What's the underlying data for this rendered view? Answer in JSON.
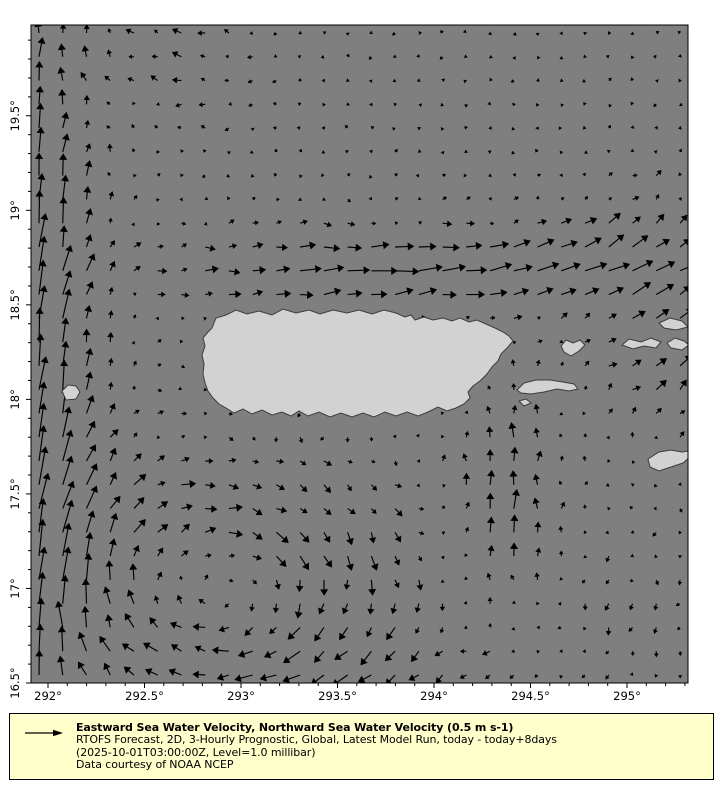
{
  "legend": {
    "title": "Eastward Sea Water Velocity, Northward Sea Water Velocity (0.5 m s-1)",
    "line2": "RTOFS Forecast, 2D, 3-Hourly Prognostic, Global, Latest Model Run, today - today+8days",
    "line3": "(2025-10-01T03:00:00Z, Level=1.0 millibar)",
    "line4": "Data courtesy of NOAA NCEP",
    "background": "#ffffcc",
    "border_color": "#000000",
    "key_arrow_icon": "reference-velocity-arrow"
  },
  "chart_data": {
    "type": "quiver",
    "title": "Eastward Sea Water Velocity, Northward Sea Water Velocity",
    "reference_vector": {
      "value": 0.5,
      "units": "m s-1"
    },
    "x_axis": {
      "tick_values": [
        292,
        292.5,
        293,
        293.5,
        294,
        294.5,
        295
      ],
      "tick_labels": [
        "292°",
        "292.5°",
        "293°",
        "293.5°",
        "294°",
        "294.5°",
        "295°"
      ],
      "range": [
        291.912,
        295.316
      ],
      "minor_step": 0.1
    },
    "y_axis": {
      "tick_values": [
        19.5,
        19,
        18.5,
        18,
        17.5,
        17,
        16.5
      ],
      "tick_labels": [
        "19.5°",
        "19°",
        "18.5°",
        "18°",
        "17.5°",
        "17°",
        "16.5°"
      ],
      "range": [
        16.5,
        19.98
      ],
      "minor_step": 0.1
    },
    "colors": {
      "ocean": "#7f7f7f",
      "land": "#d2d2d2",
      "coast": "#3c3c3c",
      "arrow": "#000000",
      "axis": "#000000"
    },
    "grid": {
      "cols": 28,
      "rows": 28,
      "inset_px": 8,
      "scale_px_per_unit": 75,
      "max_arrow_px": 40,
      "noise_amplitude": 0.045
    },
    "flow_features": [
      {
        "name": "mona-passage-northward-jet",
        "type": "gauss",
        "lon0": 291.88,
        "lat0": 18.2,
        "sx": 0.36,
        "sy": 1.9,
        "u": 0.05,
        "v": 0.48
      },
      {
        "name": "northwest-westward-turn",
        "type": "gauss",
        "lon0": 292.6,
        "lat0": 19.8,
        "sx": 0.5,
        "sy": 0.35,
        "u": -0.1,
        "v": 0.02
      },
      {
        "name": "north-coast-eastward-band",
        "type": "gauss",
        "lon0": 293.9,
        "lat0": 18.68,
        "sx": 1.25,
        "sy": 0.22,
        "u": 0.32,
        "v": 0.03
      },
      {
        "name": "northeast-tilt",
        "type": "gauss",
        "lon0": 295.1,
        "lat0": 18.8,
        "sx": 0.6,
        "sy": 0.35,
        "u": 0.1,
        "v": 0.12
      },
      {
        "name": "southwest-anticyclonic-eddy",
        "type": "eddy",
        "lon0": 292.9,
        "lat0": 17.0,
        "rx": 0.85,
        "ry": 0.62,
        "k": 0.42
      },
      {
        "name": "southeast-northward-band",
        "type": "gauss",
        "lon0": 294.35,
        "lat0": 17.45,
        "sx": 0.3,
        "sy": 0.6,
        "u": 0.0,
        "v": 0.26
      },
      {
        "name": "east-northeast-flow",
        "type": "gauss",
        "lon0": 295.3,
        "lat0": 18.2,
        "sx": 0.5,
        "sy": 0.4,
        "u": 0.13,
        "v": 0.12
      },
      {
        "name": "south-coast-westward-drift",
        "type": "gauss",
        "lon0": 293.5,
        "lat0": 17.85,
        "sx": 0.7,
        "sy": 0.16,
        "u": -0.09,
        "v": -0.02
      },
      {
        "name": "southeast-corner-southward-drift",
        "type": "gauss",
        "lon0": 295.1,
        "lat0": 16.9,
        "sx": 0.5,
        "sy": 0.4,
        "u": -0.02,
        "v": -0.08
      },
      {
        "name": "south-bottom-westward",
        "type": "gauss",
        "lon0": 293.8,
        "lat0": 16.6,
        "sx": 0.8,
        "sy": 0.25,
        "u": -0.08,
        "v": -0.03
      }
    ],
    "islands": [
      {
        "name": "puerto-rico",
        "points": [
          [
            212,
            328
          ],
          [
            216,
            318
          ],
          [
            226,
            315
          ],
          [
            236,
            310
          ],
          [
            247,
            314
          ],
          [
            259,
            311
          ],
          [
            272,
            315
          ],
          [
            283,
            309
          ],
          [
            296,
            313
          ],
          [
            309,
            310
          ],
          [
            320,
            314
          ],
          [
            333,
            310
          ],
          [
            347,
            313
          ],
          [
            359,
            310
          ],
          [
            372,
            314
          ],
          [
            384,
            310
          ],
          [
            396,
            313
          ],
          [
            405,
            317
          ],
          [
            411,
            315
          ],
          [
            415,
            320
          ],
          [
            424,
            317
          ],
          [
            433,
            320
          ],
          [
            443,
            318
          ],
          [
            452,
            321
          ],
          [
            460,
            318
          ],
          [
            469,
            322
          ],
          [
            477,
            320
          ],
          [
            486,
            324
          ],
          [
            495,
            328
          ],
          [
            503,
            332
          ],
          [
            509,
            336
          ],
          [
            513,
            341
          ],
          [
            507,
            348
          ],
          [
            501,
            354
          ],
          [
            498,
            361
          ],
          [
            492,
            367
          ],
          [
            487,
            374
          ],
          [
            480,
            381
          ],
          [
            473,
            386
          ],
          [
            468,
            392
          ],
          [
            470,
            398
          ],
          [
            464,
            404
          ],
          [
            456,
            408
          ],
          [
            447,
            411
          ],
          [
            438,
            407
          ],
          [
            428,
            412
          ],
          [
            418,
            416
          ],
          [
            407,
            412
          ],
          [
            396,
            416
          ],
          [
            385,
            412
          ],
          [
            374,
            417
          ],
          [
            363,
            413
          ],
          [
            352,
            417
          ],
          [
            341,
            413
          ],
          [
            330,
            417
          ],
          [
            319,
            412
          ],
          [
            308,
            416
          ],
          [
            299,
            411
          ],
          [
            291,
            416
          ],
          [
            282,
            412
          ],
          [
            272,
            415
          ],
          [
            262,
            410
          ],
          [
            252,
            414
          ],
          [
            243,
            409
          ],
          [
            234,
            413
          ],
          [
            226,
            408
          ],
          [
            219,
            404
          ],
          [
            213,
            398
          ],
          [
            208,
            391
          ],
          [
            205,
            383
          ],
          [
            203,
            374
          ],
          [
            204,
            364
          ],
          [
            202,
            355
          ],
          [
            205,
            346
          ],
          [
            203,
            338
          ],
          [
            208,
            332
          ]
        ]
      },
      {
        "name": "vieques",
        "points": [
          [
            517,
            390
          ],
          [
            524,
            383
          ],
          [
            536,
            380
          ],
          [
            550,
            380
          ],
          [
            563,
            382
          ],
          [
            574,
            384
          ],
          [
            578,
            389
          ],
          [
            569,
            391
          ],
          [
            557,
            389
          ],
          [
            544,
            392
          ],
          [
            531,
            394
          ],
          [
            521,
            393
          ]
        ]
      },
      {
        "name": "culebra",
        "points": [
          [
            561,
            346
          ],
          [
            566,
            340
          ],
          [
            573,
            343
          ],
          [
            580,
            340
          ],
          [
            585,
            345
          ],
          [
            579,
            351
          ],
          [
            571,
            356
          ],
          [
            564,
            352
          ]
        ]
      },
      {
        "name": "st-thomas",
        "points": [
          [
            622,
            345
          ],
          [
            629,
            339
          ],
          [
            641,
            342
          ],
          [
            651,
            338
          ],
          [
            661,
            342
          ],
          [
            656,
            348
          ],
          [
            644,
            346
          ],
          [
            633,
            349
          ]
        ]
      },
      {
        "name": "tortola",
        "points": [
          [
            667,
            343
          ],
          [
            675,
            338
          ],
          [
            684,
            341
          ],
          [
            689,
            345
          ],
          [
            682,
            350
          ],
          [
            671,
            348
          ]
        ]
      },
      {
        "name": "northeast-cay",
        "points": [
          [
            659,
            323
          ],
          [
            670,
            318
          ],
          [
            682,
            321
          ],
          [
            688,
            327
          ],
          [
            676,
            330
          ],
          [
            664,
            328
          ]
        ]
      },
      {
        "name": "st-croix",
        "points": [
          [
            648,
            459
          ],
          [
            659,
            452
          ],
          [
            671,
            450
          ],
          [
            682,
            452
          ],
          [
            689,
            451
          ],
          [
            690,
            457
          ],
          [
            683,
            463
          ],
          [
            671,
            467
          ],
          [
            659,
            471
          ],
          [
            650,
            467
          ]
        ]
      },
      {
        "name": "mona",
        "points": [
          [
            62,
            391
          ],
          [
            68,
            385
          ],
          [
            76,
            386
          ],
          [
            80,
            392
          ],
          [
            76,
            399
          ],
          [
            66,
            400
          ]
        ]
      },
      {
        "name": "vieques-west-cay",
        "points": [
          [
            519,
            401
          ],
          [
            526,
            399
          ],
          [
            531,
            403
          ],
          [
            524,
            406
          ]
        ]
      }
    ]
  }
}
